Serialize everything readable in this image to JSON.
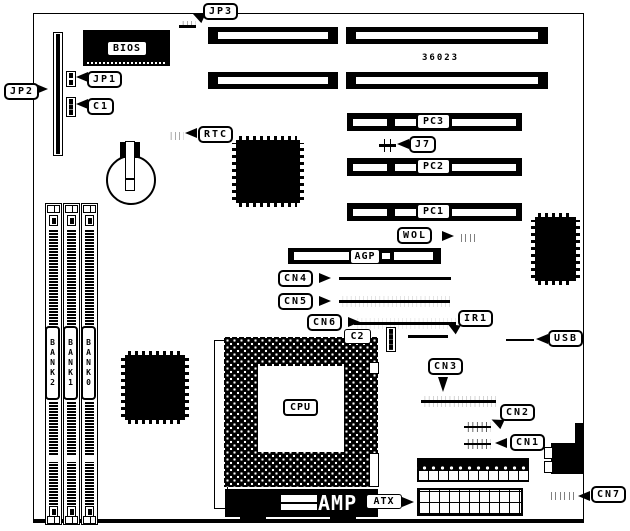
{
  "diagram_title": "motherboard layout diagram",
  "board_number": "36023",
  "callouts": {
    "jp1": "JP1",
    "jp2": "JP2",
    "jp3": "JP3",
    "c1": "C1",
    "rtc": "RTC",
    "j7": "J7",
    "wol": "WOL",
    "ir1": "IR1",
    "usb": "USB",
    "cn1": "CN1",
    "cn2": "CN2",
    "cn3": "CN3",
    "cn4": "CN4",
    "cn5": "CN5",
    "cn6": "CN6",
    "cn7": "CN7",
    "atx": "ATX"
  },
  "slots": {
    "pc1": "PC1",
    "pc2": "PC2",
    "pc3": "PC3",
    "agp": "AGP"
  },
  "chips": {
    "bios": "BIOS",
    "cpu": "CPU",
    "c2": "C2",
    "amp": "AMP"
  },
  "memory_banks": [
    {
      "label": "BANK2"
    },
    {
      "label": "BANK1"
    },
    {
      "label": "BANK0"
    }
  ],
  "colors": {
    "ink": "#000000",
    "paper": "#ffffff"
  }
}
